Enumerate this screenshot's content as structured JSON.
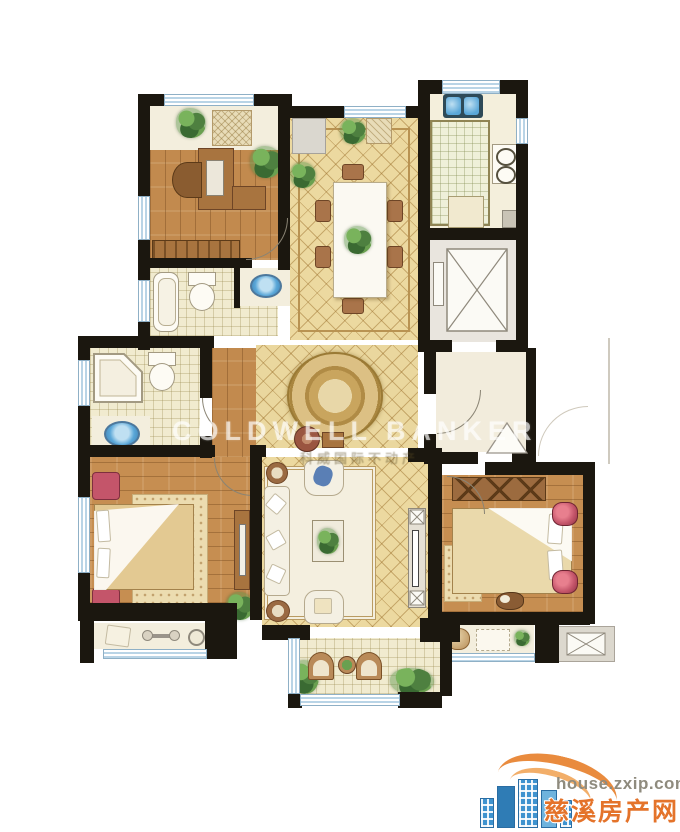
{
  "watermark": {
    "brand": "COLDWELL BANKER",
    "brand_cn": "科威国际不动产"
  },
  "logo": {
    "url": "house.zxip.com",
    "site_name": "慈溪房产网"
  },
  "palette": {
    "wall": "#1b170f",
    "wood_floor": "#c28a4e",
    "tile_gold": "#ecd9a0",
    "tile_cream": "#f1ebcf",
    "cream_floor": "#f3eedd",
    "window_blue": "#b9d4e6",
    "plant_green": "#4e8040",
    "fixture_white": "#fdfbf4",
    "sink_blue": "#5aa7d8",
    "accent_red": "#c4556a",
    "elevator_gray": "#e9e5de",
    "watermark_white": "rgba(255,255,255,0.62)",
    "logo_orange": "#e8822e",
    "logo_blue": "#3f93cf",
    "logo_url_gray": "#8f8b7e"
  },
  "icons": {
    "logo_mark": "city-buildings-with-arcs-icon",
    "elevator_shaft": "crossed-box-elevator-icon",
    "ac_platform": "crossed-box-ac-icon",
    "entry_door": "door-swing-triangle-icon"
  }
}
